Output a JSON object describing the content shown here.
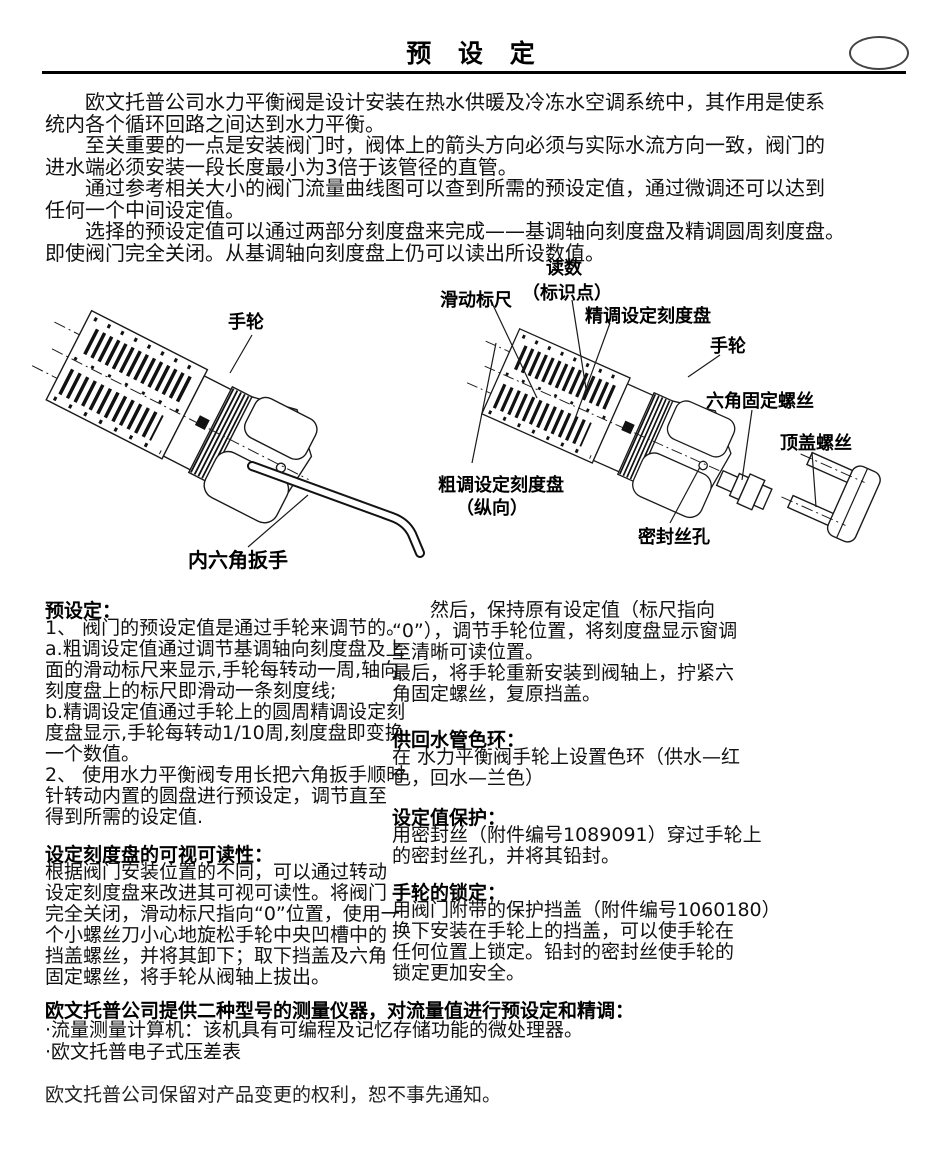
{
  "page": {
    "title": "预 设 定",
    "footer": "欧文托普公司保留对产品变更的权利，恕不事先通知。"
  },
  "intro": {
    "lines": [
      "　　欧文托普公司水力平衡阀是设计安装在热水供暖及冷冻水空调系统中，其作用是使系",
      "统内各个循环回路之间达到水力平衡。",
      "　　至关重要的一点是安装阀门时，阀体上的箭头方向必须与实际水流方向一致，阀门的",
      "进水端必须安装一段长度最小为3倍于该管径的直管。",
      "　　通过参考相关大小的阀门流量曲线图可以查到所需的预设定值，通过微调还可以达到",
      "任何一个中间设定值。",
      "　　选择的预设定值可以通过两部分刻度盘来完成——基调轴向刻度盘及精调圆周刻度盘。",
      "即使阀门完全关闭。从基调轴向刻度盘上仍可以读出所设数值。"
    ]
  },
  "figure": {
    "left_labels": {
      "handwheel": "手轮",
      "allen_key": "内六角扳手"
    },
    "right_labels": {
      "sliding_scale": "滑动标尺",
      "reading": "读数",
      "reading_sub": "（标识点）",
      "fine_dial": "精调设定刻度盘",
      "handwheel": "手轮",
      "hex_set_screw": "六角固定螺丝",
      "top_cover_screw": "顶盖螺丝",
      "coarse_dial": "粗调设定刻度盘",
      "coarse_dial_sub": "（纵向）",
      "seal_wire_hole": "密封丝孔"
    }
  },
  "left_column": {
    "preset": {
      "heading": "预设定：",
      "lines": [
        "1、 阀门的预设定值是通过手轮来调节的。",
        "a.粗调设定值通过调节基调轴向刻度盘及上",
        "面的滑动标尺来显示,手轮每转动一周,轴向",
        "刻度盘上的标尺即滑动一条刻度线;",
        "b.精调设定值通过手轮上的圆周精调设定刻",
        "度盘显示,手轮每转动1/10周,刻度盘即变换",
        "一个数值。",
        "2、 使用水力平衡阀专用长把六角扳手顺时",
        "针转动内置的圆盘进行预设定，调节直至",
        "得到所需的设定值."
      ]
    },
    "readability": {
      "heading": "设定刻度盘的可视可读性：",
      "lines": [
        "根据阀门安装位置的不同，可以通过转动",
        "设定刻度盘来改进其可视可读性。将阀门",
        "完全关闭，滑动标尺指向“0”位置，使用一",
        "个小螺丝刀小心地旋松手轮中央凹槽中的",
        "挡盖螺丝，并将其卸下；取下挡盖及六角",
        "固定螺丝，将手轮从阀轴上拔出。"
      ]
    }
  },
  "right_column": {
    "then": {
      "lines": [
        "　　然后，保持原有设定值（标尺指向",
        "“0”），调节手轮位置，将刻度盘显示窗调",
        "至清晰可读位置。",
        "最后，将手轮重新安装到阀轴上，拧紧六",
        "角固定螺丝，复原挡盖。"
      ]
    },
    "color_rings": {
      "heading": "供回水管色环：",
      "lines": [
        "在 水力平衡阀手轮上设置色环（供水—红",
        "色，回水—兰色）"
      ]
    },
    "setting_protection": {
      "heading": "设定值保护：",
      "lines": [
        "用密封丝（附件编号1089091）穿过手轮上",
        "的密封丝孔，并将其铅封。"
      ]
    },
    "handwheel_locking": {
      "heading": "手轮的锁定：",
      "lines": [
        "用阀门附带的保护挡盖（附件编号1060180）",
        "换下安装在手轮上的挡盖，可以使手轮在",
        "任何位置上锁定。铅封的密封丝使手轮的",
        "锁定更加安全。"
      ]
    }
  },
  "bottom": {
    "heading": "欧文托普公司提供二种型号的测量仪器，对流量值进行预设定和精调：",
    "bullets": [
      "·流量测量计算机：该机具有可编程及记忆存储功能的微处理器。",
      "·欧文托普电子式压差表"
    ]
  }
}
